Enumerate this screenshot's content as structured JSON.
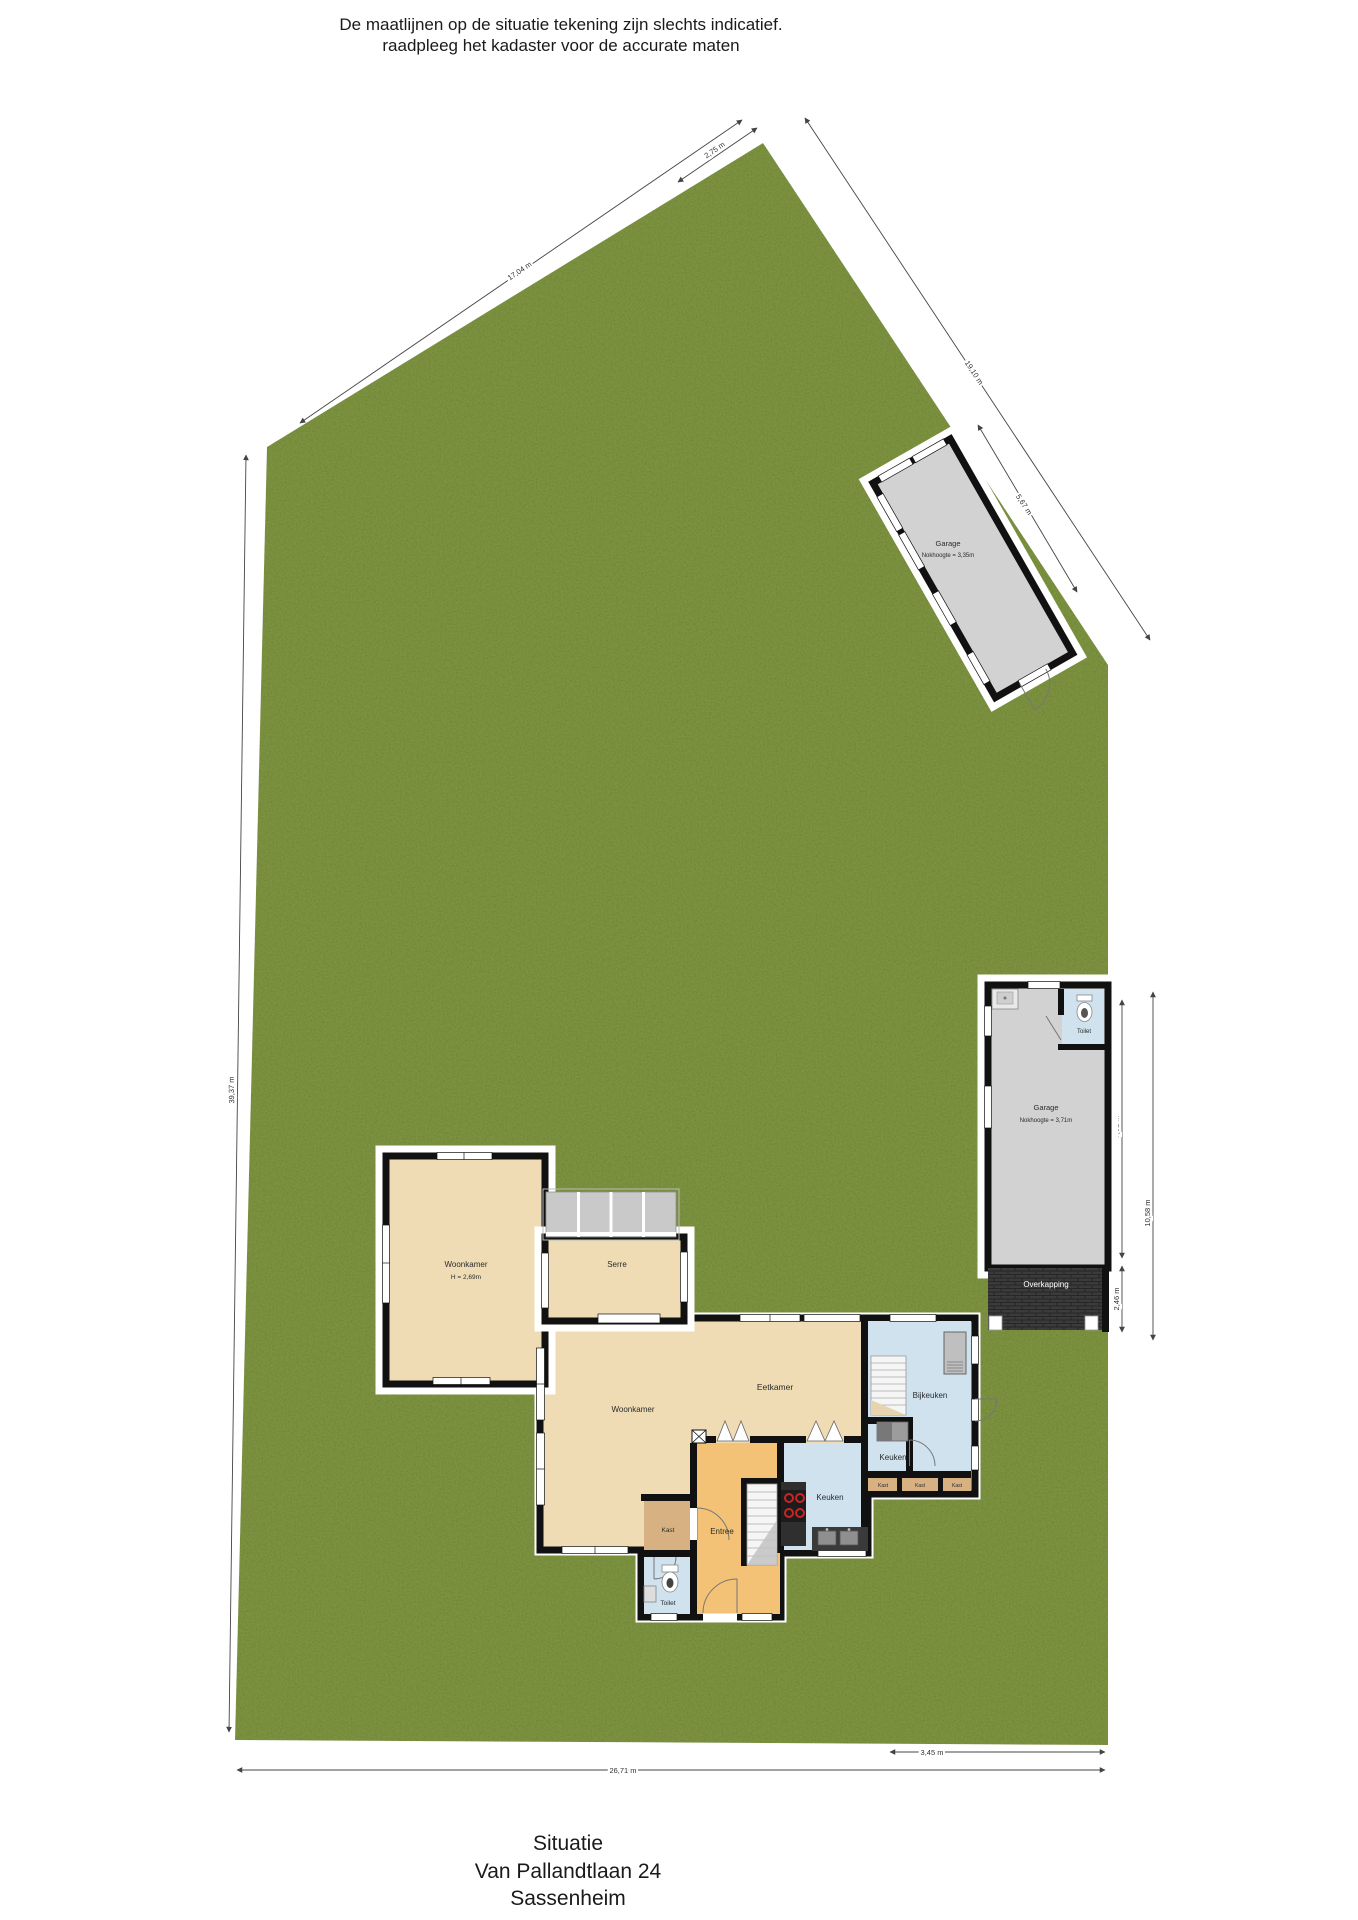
{
  "disclaimer": {
    "line1": "De maatlijnen op de situatie tekening zijn slechts indicatief.",
    "line2": "raadpleeg het kadaster voor de accurate maten"
  },
  "footer": {
    "title": "Situatie",
    "address": "Van Pallandtlaan 24",
    "city": "Sassenheim"
  },
  "house": {
    "woonkamer_links": {
      "label": "Woonkamer",
      "ceiling": "H = 2,69m"
    },
    "serre": {
      "label": "Serre"
    },
    "woonkamer": {
      "label": "Woonkamer"
    },
    "eetkamer": {
      "label": "Eetkamer"
    },
    "bijkeuken": {
      "label": "Bijkeuken"
    },
    "keuken_klein": {
      "label": "Keuken"
    },
    "keuken": {
      "label": "Keuken"
    },
    "kast": {
      "label": "Kast"
    },
    "kast_row": [
      "Kast",
      "Kast",
      "Kast"
    ],
    "entree": {
      "label": "Entree"
    },
    "toilet": {
      "label": "Toilet"
    }
  },
  "garage_noord": {
    "label": "Garage",
    "sub": "Nokhoogte = 3,35m"
  },
  "garage_oost": {
    "label": "Garage",
    "sub": "Nokhoogte = 3,71m",
    "toilet_label": "Toilet"
  },
  "overkapping": {
    "label": "Overkapping"
  },
  "dimensions": {
    "top_left_edge": "17,04 m",
    "top_apex": "2,75 m",
    "top_right_edge": "19,10 m",
    "garage_zijde": "5,67 m",
    "garage_diepte": "7,61 m",
    "overkapping_diepte": "2,46 m",
    "rechts_onder": "10,58 m",
    "links": "39,37 m",
    "onder": "26,71 m",
    "onder_rechts": "3,45 m"
  },
  "colors": {
    "grass": "#7d9243",
    "wall": "#111111",
    "room_beige": "#efdcb4",
    "room_blue": "#cfe2ee",
    "room_orange": "#f3c277",
    "room_tan": "#d8b183",
    "garage_gray": "#d2d2d2",
    "overkapping_dark": "#3b3b3b"
  }
}
